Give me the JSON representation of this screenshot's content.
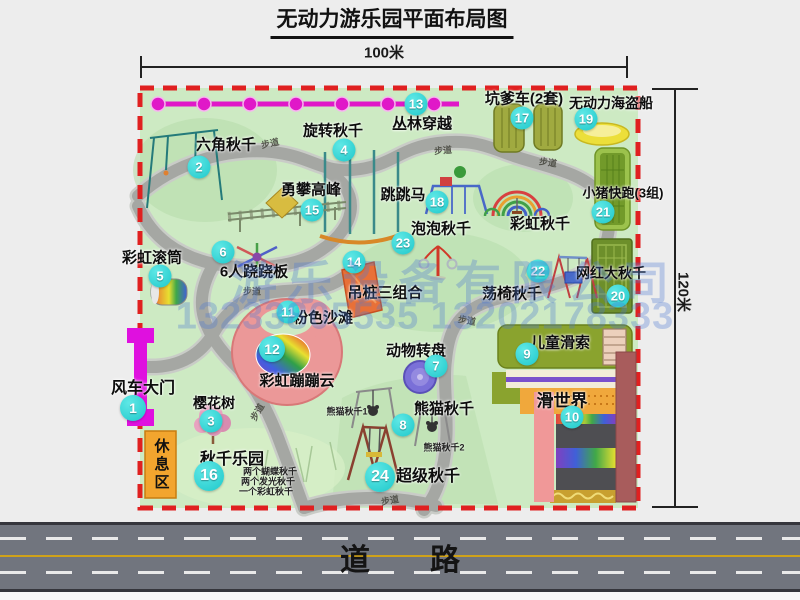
{
  "title": "无动力游乐园平面布局图",
  "dim_width": "100米",
  "dim_height": "120米",
  "road_label": "道　　路",
  "footpath": "步道",
  "rest_area": "休息区",
  "watermark": {
    "company": "游乐设备有限公司",
    "phone": "13233805535 13202178333"
  },
  "attractions": [
    {
      "id": "1",
      "name": "风车大门"
    },
    {
      "id": "2",
      "name": "六角秋千"
    },
    {
      "id": "3",
      "name": "樱花树"
    },
    {
      "id": "4",
      "name": "旋转秋千"
    },
    {
      "id": "5",
      "name": "彩虹滚筒"
    },
    {
      "id": "6",
      "name": "6人跷跷板"
    },
    {
      "id": "7",
      "name": "动物转盘"
    },
    {
      "id": "8",
      "name": "熊猫秋千"
    },
    {
      "id": "9",
      "name": "儿童滑索"
    },
    {
      "id": "10",
      "name": "滑世界"
    },
    {
      "id": "11",
      "name": "粉色沙滩"
    },
    {
      "id": "12",
      "name": "彩虹蹦蹦云"
    },
    {
      "id": "13",
      "name": "丛林穿越"
    },
    {
      "id": "14",
      "name": "吊桩三组合"
    },
    {
      "id": "15",
      "name": "勇攀高峰"
    },
    {
      "id": "16",
      "name": "秋千乐园"
    },
    {
      "id": "17",
      "name": "坑爹车(2套)"
    },
    {
      "id": "18",
      "name": "跳跳马"
    },
    {
      "id": "19",
      "name": "无动力海盗船"
    },
    {
      "id": "20",
      "name": "网红大秋千"
    },
    {
      "id": "21",
      "name": "小猪快跑(3组)"
    },
    {
      "id": "22",
      "name": "荡椅秋千"
    },
    {
      "id": "23",
      "name": "泡泡秋千"
    },
    {
      "id": "24",
      "name": "超级秋千"
    }
  ],
  "extra_labels": {
    "rainbow_swing": "彩虹秋千",
    "panda_swing_1": "熊猫秋千1",
    "panda_swing_2": "熊猫秋千2",
    "swing_note_1": "两个蝴蝶秋千",
    "swing_note_2": "两个发光秋千",
    "swing_note_3": "一个彩虹秋千"
  },
  "colors": {
    "park_green": "#cdeac3",
    "boundary_red": "#e02020",
    "badge_cyan": "#2ed3d3",
    "zipline_magenta": "#e018c8",
    "gate_magenta": "#df10df",
    "rest_area_orange": "#f2a52e",
    "road_gray": "#71757e"
  }
}
